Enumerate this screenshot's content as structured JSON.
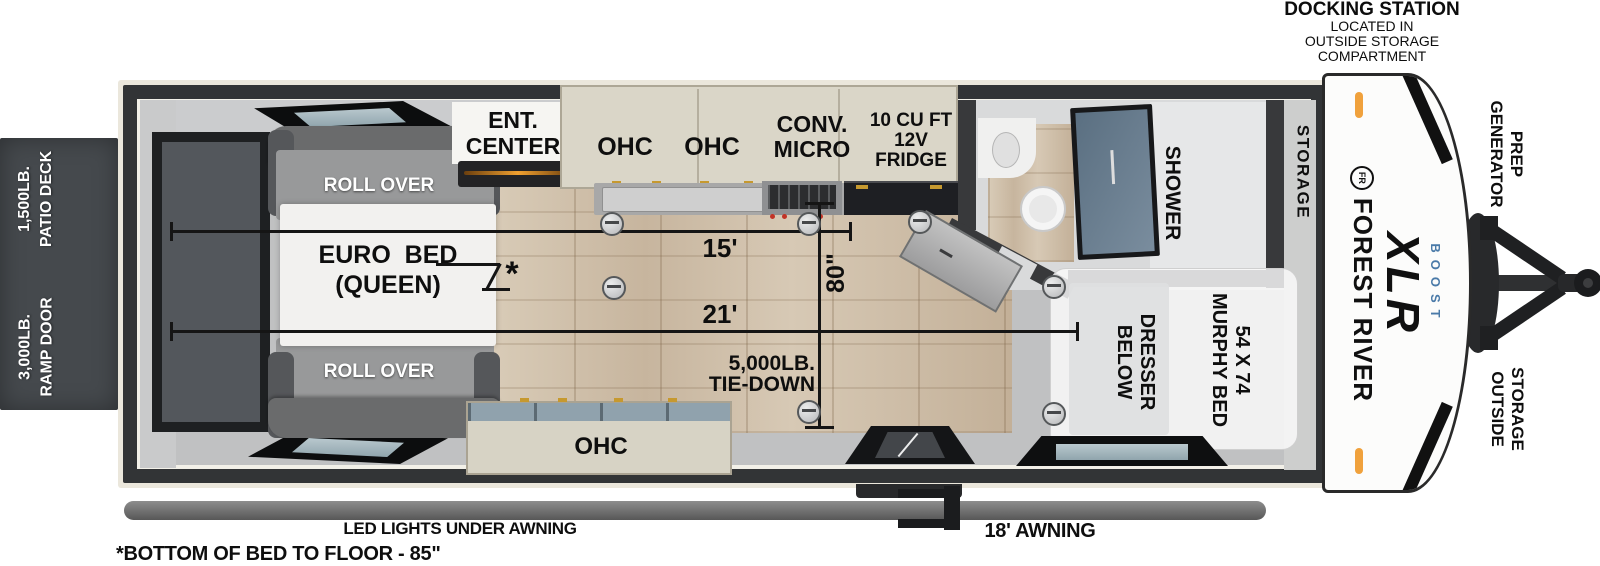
{
  "labels": {
    "docking": {
      "title": "DOCKING STATION",
      "lines": [
        "LOCATED IN",
        "OUTSIDE STORAGE",
        "COMPARTMENT"
      ]
    },
    "patio_deck": {
      "line1": "1,500LB.",
      "line2": "PATIO DECK"
    },
    "ramp_door": {
      "line1": "3,000LB.",
      "line2": "RAMP DOOR"
    },
    "generator_prep": {
      "line1": "GENERATOR",
      "line2": "PREP"
    },
    "outside_storage": {
      "line1": "OUTSIDE",
      "line2": "STORAGE"
    },
    "led_lights": "LED LIGHTS UNDER AWNING",
    "awning_length": "18' AWNING",
    "footnote": "*BOTTOM OF BED TO FLOOR - 85\""
  },
  "interior": {
    "ent_center": {
      "line1": "ENT.",
      "line2": "CENTER"
    },
    "ohc_left": "OHC",
    "ohc_right": "OHC",
    "ohc_bottom": "OHC",
    "conv_micro": {
      "line1": "CONV.",
      "line2": "MICRO"
    },
    "fridge": {
      "line1": "10 CU FT",
      "line2": "12V",
      "line3": "FRIDGE"
    },
    "roll_over_front": "ROLL OVER",
    "roll_over_rear": "ROLL OVER",
    "euro_bed": {
      "line1": "EURO  BED",
      "line2": "(QUEEN)"
    },
    "shower": "SHOWER",
    "storage": "STORAGE",
    "murphy_bed": {
      "line1": "54 X 74",
      "line2": "MURPHY BED"
    },
    "dresser": {
      "line1": "DRESSER",
      "line2": "BELOW"
    },
    "tie_down": {
      "line1": "5,000LB.",
      "line2": "TIE-DOWN"
    }
  },
  "dimensions": {
    "kitchen_run": "15'",
    "main_run": "21'",
    "interior_width": "80\"",
    "footnote_marker": "*"
  },
  "branding": {
    "emblem": "FR",
    "make": "FOREST RIVER",
    "model": "XLR",
    "trim": "BOOST"
  },
  "colors": {
    "marker_light": "#F0A13C",
    "boost_blue": "#4A7AA8",
    "wall": "#333537",
    "floor": "#D3C4B0"
  }
}
